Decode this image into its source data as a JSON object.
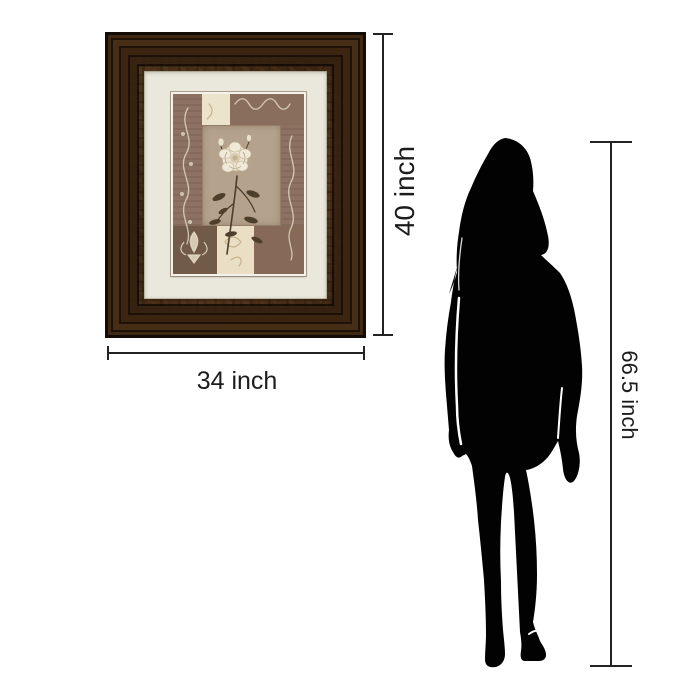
{
  "scene": {
    "background_color": "#ffffff",
    "description_labels": []
  },
  "framed_art": {
    "frame_outer_color": "#2a1a0d",
    "frame_bronze_color": "#7a5229",
    "mat_color": "#eae8dc",
    "artwork": {
      "base_color": "#8d7263",
      "center_panel_color": "#b5a28c",
      "cream_patch_color": "#ece3cb",
      "dark_patch_color": "#715a47",
      "rose_petal_color": "#f0e9d8",
      "leaf_color": "#4e3f2c",
      "scroll_color": "#ece5d2"
    }
  },
  "silhouette": {
    "color": "#020202"
  },
  "dimensions": {
    "line_color": "#222222",
    "frame_height_label": "40 inch",
    "frame_width_label": "34 inch",
    "person_height_label": "66.5 inch"
  }
}
